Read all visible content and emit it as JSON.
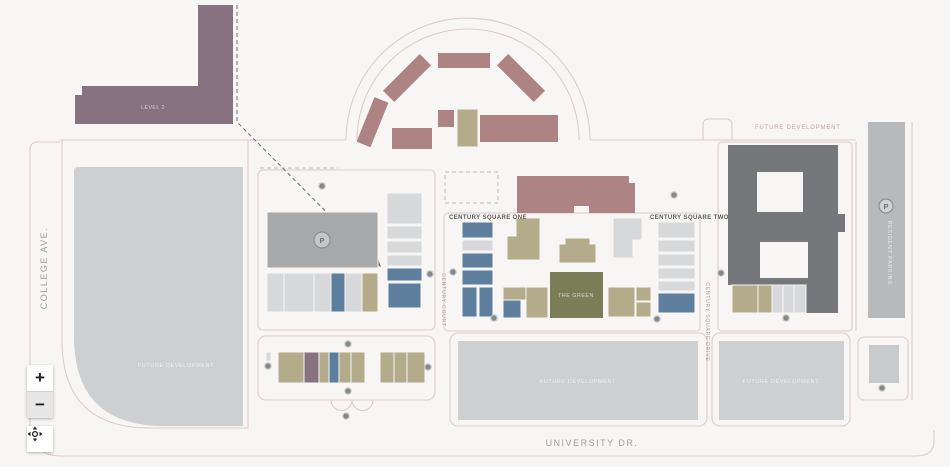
{
  "palette": {
    "background": "#f7f6f5",
    "road": "#ddccc7",
    "building_rose": "#ae8384",
    "building_purple": "#877380",
    "building_tan": "#b4ab8b",
    "building_blue": "#5d7e9c",
    "building_gray": "#a7a8aa",
    "building_light_gray": "#d7d8da",
    "building_dark_gray": "#75777a",
    "building_olive": "#7b7d57",
    "future_block_gray": "#cdcfd0",
    "marker_gray": "#85888b",
    "street_label": "#a59b96",
    "area_label": "#5d5a57",
    "future_label_pink": "#c0a49e"
  },
  "streets": {
    "college_ave": "COLLEGE AVE.",
    "university_dr": "UNIVERSITY DR.",
    "century_court": "CENTURY COURT",
    "century_square_drive": "CENTURY SQUARE DRIVE"
  },
  "areas": {
    "level2_label": "LEVEL 2",
    "century_square_one": "CENTURY SQUARE ONE",
    "century_square_two": "CENTURY SQUARE TWO",
    "the_green": "THE GREEN",
    "resident_parking": "RESIDENT PARKING",
    "future_development_top_right": "FUTURE DEVELOPMENT",
    "future_development_left": "FUTURE DEVELOPMENT",
    "future_development_bottom_center": "FUTURE DEVELOPMENT",
    "future_development_bottom_right": "FUTURE DEVELOPMENT"
  },
  "badges": {
    "parking": "P"
  },
  "controls": {
    "zoom_in": "+",
    "zoom_out": "−"
  }
}
